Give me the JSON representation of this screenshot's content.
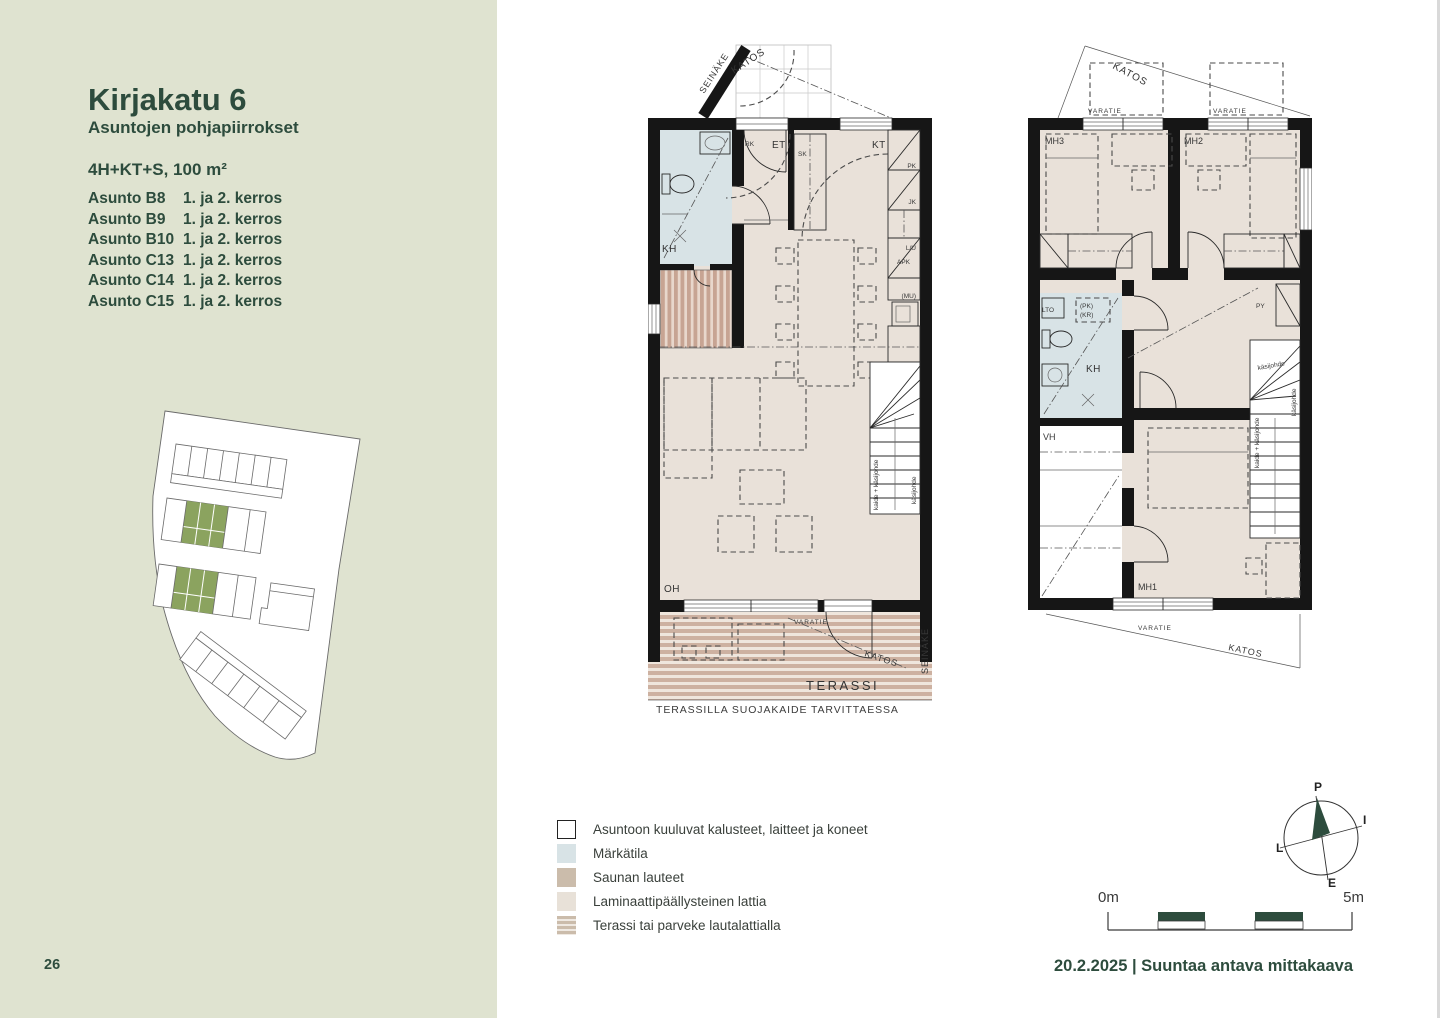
{
  "page": {
    "number": "26"
  },
  "sidebar": {
    "title": "Kirjakatu 6",
    "subtitle": "Asuntojen pohjapiirrokset",
    "unit_type": "4H+KT+S, 100 m²",
    "apartments": [
      {
        "name": "Asunto B8",
        "floors": "1. ja 2. kerros"
      },
      {
        "name": "Asunto B9",
        "floors": "1. ja 2. kerros"
      },
      {
        "name": "Asunto B10",
        "floors": "1. ja 2. kerros"
      },
      {
        "name": "Asunto C13",
        "floors": "1. ja 2. kerros"
      },
      {
        "name": "Asunto C14",
        "floors": "1. ja 2. kerros"
      },
      {
        "name": "Asunto C15",
        "floors": "1. ja 2. kerros"
      }
    ]
  },
  "plan1": {
    "labels": {
      "seinake": "SEINÄKE",
      "katos": "KATOS",
      "rk": "RK",
      "et": "ET",
      "sk": "SK",
      "kt": "KT",
      "pk": "PK",
      "jk": "JK",
      "lu": "L/U",
      "apk": "APK",
      "mu": "(MU)",
      "kh": "KH",
      "oh": "OH",
      "stair1": "kaide + käsijohde",
      "stair2": "käsijohde",
      "varatie": "VARATIE",
      "katos_terrace": "KATOS",
      "seinake_terrace": "SEINÄKE",
      "terassi": "TERASSI"
    },
    "caption": "TERASSILLA SUOJAKAIDE TARVITTAESSA"
  },
  "plan2": {
    "labels": {
      "katos": "KATOS",
      "varatie_left": "VARATIE",
      "varatie_right": "VARATIE",
      "mh3": "MH3",
      "mh2": "MH2",
      "mh1": "MH1",
      "py": "PY",
      "lto": "LTO",
      "pk": "(PK)",
      "kr": "(KR)",
      "kh": "KH",
      "vh": "VH",
      "stair1": "käsijohde",
      "stair2": "käsijohde",
      "stair3": "kaide + käsijohde",
      "varatie_bottom": "VARATIE",
      "katos_bottom": "KATOS"
    }
  },
  "legend": {
    "items": [
      {
        "label": "Asuntoon kuuluvat kalusteet, laitteet ja koneet"
      },
      {
        "label": "Märkätila"
      },
      {
        "label": "Saunan lauteet"
      },
      {
        "label": "Laminaattipäällysteinen lattia"
      },
      {
        "label": "Terassi tai parveke lautalattialla"
      }
    ]
  },
  "compass": {
    "north": "P",
    "east": "I",
    "south": "E",
    "west": "L"
  },
  "scalebar": {
    "start": "0m",
    "end": "5m"
  },
  "footer": {
    "text": "20.2.2025 | Suuntaa antava mittakaava"
  },
  "colors": {
    "sidebar_bg": "#dfe3d0",
    "accent_green": "#2d4c3d",
    "wet_room": "#d8e3e6",
    "laminate": "#e9e1d9",
    "deck_stripe": "#cdb1a1",
    "sauna_stripe": "#c7a493",
    "site_green": "#8ba35f",
    "wall": "#161616"
  }
}
